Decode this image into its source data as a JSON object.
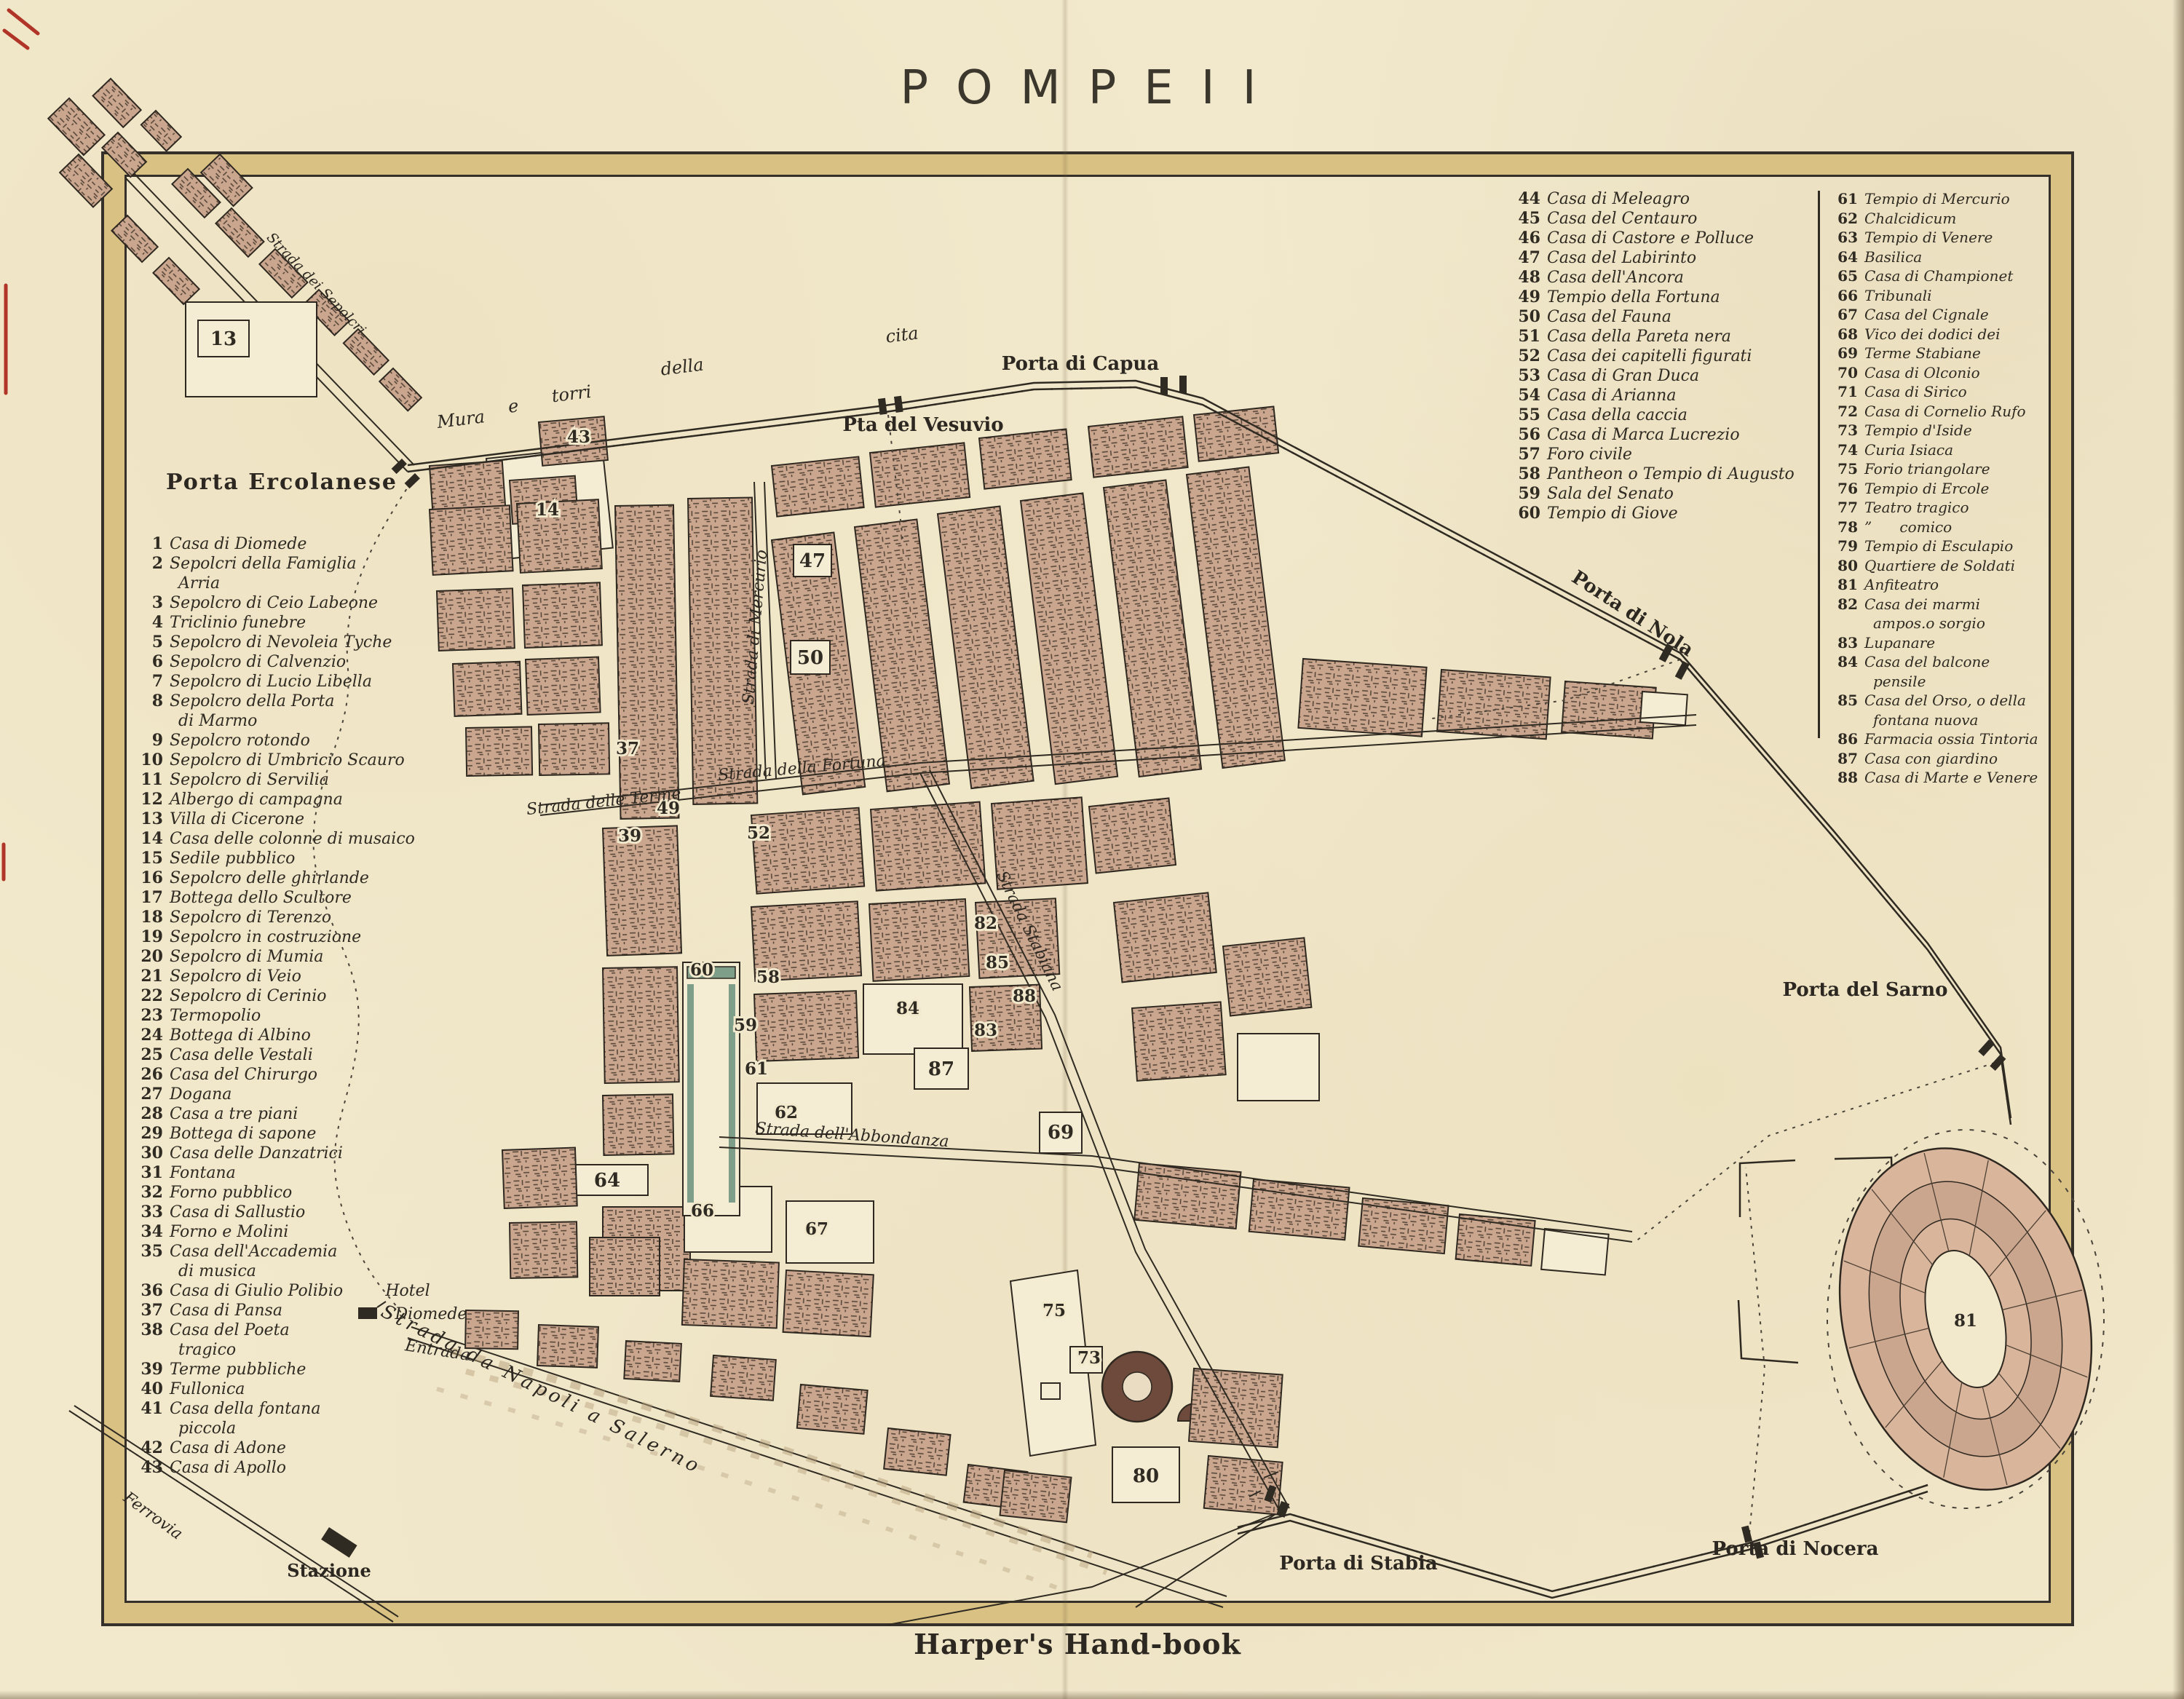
{
  "title": "POMPEII",
  "footer": "Harper's Hand-book",
  "colors": {
    "paper": "#f2e9cd",
    "ink": "#2f2a22",
    "block_brown": "#cba68e",
    "frame_band": "#d8c183",
    "colonnade_green": "#7e9e8a",
    "red_ink": "#b03528"
  },
  "legend_left": {
    "items": [
      {
        "n": "1",
        "label": "Casa di Diomede"
      },
      {
        "n": "2",
        "label": "Sepolcri della Famiglia\nArria"
      },
      {
        "n": "3",
        "label": "Sepolcro di Ceio Labeone"
      },
      {
        "n": "4",
        "label": "Triclinio funebre"
      },
      {
        "n": "5",
        "label": "Sepolcro di Nevoleia Tyche"
      },
      {
        "n": "6",
        "label": "Sepolcro di Calvenzio"
      },
      {
        "n": "7",
        "label": "Sepolcro di Lucio Libella"
      },
      {
        "n": "8",
        "label": "Sepolcro della Porta\ndi Marmo"
      },
      {
        "n": "9",
        "label": "Sepolcro rotondo"
      },
      {
        "n": "10",
        "label": "Sepolcro di Umbricio Scauro"
      },
      {
        "n": "11",
        "label": "Sepolcro di Servilia"
      },
      {
        "n": "12",
        "label": "Albergo di campagna"
      },
      {
        "n": "13",
        "label": "Villa di Cicerone"
      },
      {
        "n": "14",
        "label": "Casa delle colonne di musaico"
      },
      {
        "n": "15",
        "label": "Sedile pubblico"
      },
      {
        "n": "16",
        "label": "Sepolcro delle ghirlande"
      },
      {
        "n": "17",
        "label": "Bottega dello Scultore"
      },
      {
        "n": "18",
        "label": "Sepolcro di Terenzo"
      },
      {
        "n": "19",
        "label": "Sepolcro in costruzione"
      },
      {
        "n": "20",
        "label": "Sepolcro di Mumia"
      },
      {
        "n": "21",
        "label": "Sepolcro di Veio"
      },
      {
        "n": "22",
        "label": "Sepolcro di Cerinio"
      },
      {
        "n": "23",
        "label": "Termopolio"
      },
      {
        "n": "24",
        "label": "Bottega di Albino"
      },
      {
        "n": "25",
        "label": "Casa delle Vestali"
      },
      {
        "n": "26",
        "label": "Casa del Chirurgo"
      },
      {
        "n": "27",
        "label": "Dogana"
      },
      {
        "n": "28",
        "label": "Casa a tre piani"
      },
      {
        "n": "29",
        "label": "Bottega di sapone"
      },
      {
        "n": "30",
        "label": "Casa delle Danzatrici"
      },
      {
        "n": "31",
        "label": "Fontana"
      },
      {
        "n": "32",
        "label": "Forno pubblico"
      },
      {
        "n": "33",
        "label": "Casa di Sallustio"
      },
      {
        "n": "34",
        "label": "Forno e Molini"
      },
      {
        "n": "35",
        "label": "Casa dell'Accademia\ndi musica"
      },
      {
        "n": "36",
        "label": "Casa di Giulio Polibio"
      },
      {
        "n": "37",
        "label": "Casa di Pansa"
      },
      {
        "n": "38",
        "label": "Casa del Poeta\ntragico"
      },
      {
        "n": "39",
        "label": "Terme pubbliche"
      },
      {
        "n": "40",
        "label": "Fullonica"
      },
      {
        "n": "41",
        "label": "Casa della fontana\npiccola"
      },
      {
        "n": "42",
        "label": "Casa di Adone"
      },
      {
        "n": "43",
        "label": "Casa di Apollo"
      }
    ]
  },
  "legend_right_col1": {
    "items": [
      {
        "n": "44",
        "label": "Casa di Meleagro"
      },
      {
        "n": "45",
        "label": "Casa del Centauro"
      },
      {
        "n": "46",
        "label": "Casa di Castore e Polluce"
      },
      {
        "n": "47",
        "label": "Casa del Labirinto"
      },
      {
        "n": "48",
        "label": "Casa dell'Ancora"
      },
      {
        "n": "49",
        "label": "Tempio della Fortuna"
      },
      {
        "n": "50",
        "label": "Casa del Fauna"
      },
      {
        "n": "51",
        "label": "Casa della Pareta nera"
      },
      {
        "n": "52",
        "label": "Casa dei capitelli figurati"
      },
      {
        "n": "53",
        "label": "Casa di Gran Duca"
      },
      {
        "n": "54",
        "label": "Casa di Arianna"
      },
      {
        "n": "55",
        "label": "Casa della caccia"
      },
      {
        "n": "56",
        "label": "Casa di Marca Lucrezio"
      },
      {
        "n": "57",
        "label": "Foro civile"
      },
      {
        "n": "58",
        "label": "Pantheon o Tempio di Augusto"
      },
      {
        "n": "59",
        "label": "Sala del Senato"
      },
      {
        "n": "60",
        "label": "Tempio di Giove"
      }
    ]
  },
  "legend_right_col2": {
    "items": [
      {
        "n": "61",
        "label": "Tempio di Mercurio"
      },
      {
        "n": "62",
        "label": "Chalcidicum"
      },
      {
        "n": "63",
        "label": "Tempio di Venere"
      },
      {
        "n": "64",
        "label": "Basilica"
      },
      {
        "n": "65",
        "label": "Casa di Championet"
      },
      {
        "n": "66",
        "label": "Tribunali"
      },
      {
        "n": "67",
        "label": "Casa del Cignale"
      },
      {
        "n": "68",
        "label": "Vico dei dodici dei"
      },
      {
        "n": "69",
        "label": "Terme Stabiane"
      },
      {
        "n": "70",
        "label": "Casa di Olconio"
      },
      {
        "n": "71",
        "label": "Casa di Sirico"
      },
      {
        "n": "72",
        "label": "Casa di Cornelio Rufo"
      },
      {
        "n": "73",
        "label": "Tempio d'Iside"
      },
      {
        "n": "74",
        "label": "Curia Isiaca"
      },
      {
        "n": "75",
        "label": "Forio triangolare"
      },
      {
        "n": "76",
        "label": "Tempio di Ercole"
      },
      {
        "n": "77",
        "label": "Teatro tragico"
      },
      {
        "n": "78",
        "label": "”      comico"
      },
      {
        "n": "79",
        "label": "Tempio di Esculapio"
      },
      {
        "n": "80",
        "label": "Quartiere de Soldati"
      },
      {
        "n": "81",
        "label": "Anfiteatro"
      },
      {
        "n": "82",
        "label": "Casa dei marmi ampos.o sorgio"
      },
      {
        "n": "83",
        "label": "Lupanare"
      },
      {
        "n": "84",
        "label": "Casa del balcone pensile"
      },
      {
        "n": "85",
        "label": "Casa del Orso, o della fontana nuova"
      },
      {
        "n": "86",
        "label": "Farmacia ossia Tintoria"
      },
      {
        "n": "87",
        "label": "Casa con giardino"
      },
      {
        "n": "88",
        "label": "Casa di Marte e Venere"
      }
    ]
  },
  "map": {
    "wall_words": [
      "Mura",
      "e",
      "torri",
      "della",
      "cita"
    ],
    "gates": {
      "ercolanese": "Porta Ercolanese",
      "vesuvio": "Pta del Vesuvio",
      "capua": "Porta di Capua",
      "nola": "Porta di Nola",
      "sarno": "Porta del Sarno",
      "stabia": "Porta di Stabia",
      "nocera": "Porta di Nocera"
    },
    "streets": {
      "terme": "Strada delle Terme",
      "fortuna": "Strada della Fortuna",
      "abbondanza": "Strada dell'Abbondanza",
      "mercurio": "Strada di Mercurio",
      "stabiana": "Strada Stabiana",
      "sepolcri": "Strada dei Sepolcri",
      "napoli": "Strada da Napoli a Salerno",
      "ferrovia": "Ferrovia"
    },
    "places": {
      "hotel": "Hotel",
      "diomede": "Diomede",
      "entrada": "Entrada",
      "stazione": "Stazione"
    },
    "num": {
      "n13": "13",
      "n14": "14",
      "n37": "37",
      "n39": "39",
      "n43": "43",
      "n47": "47",
      "n49": "49",
      "n50": "50",
      "n52": "52",
      "n58": "58",
      "n59": "59",
      "n60": "60",
      "n61": "61",
      "n62": "62",
      "n64": "64",
      "n66": "66",
      "n67": "67",
      "n69": "69",
      "n73": "73",
      "n75": "75",
      "n80": "80",
      "n81": "81",
      "n82": "82",
      "n83": "83",
      "n84": "84",
      "n85": "85",
      "n87": "87",
      "n88": "88"
    }
  }
}
